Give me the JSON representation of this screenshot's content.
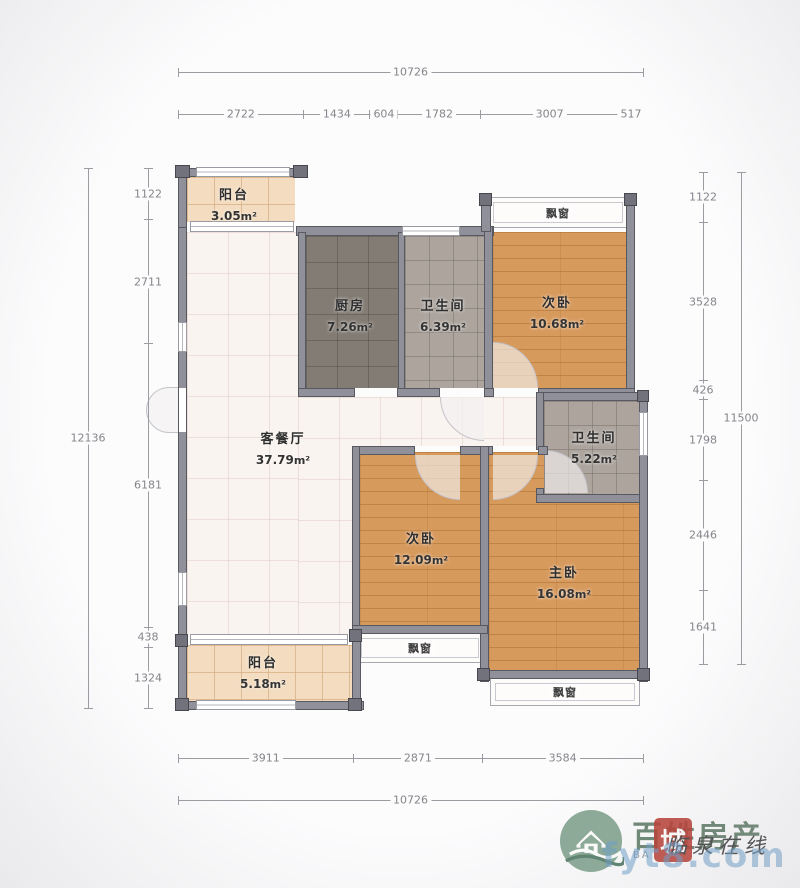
{
  "units": {
    "sqm_unit": "m²"
  },
  "plan": {
    "rooms": {
      "balcony_top": {
        "label": "阳台",
        "area": "3.05"
      },
      "kitchen": {
        "label": "厨房",
        "area": "7.26"
      },
      "bath_top": {
        "label": "卫生间",
        "area": "6.39"
      },
      "bedroom_top": {
        "label": "次卧",
        "area": "10.68"
      },
      "living": {
        "label": "客餐厅",
        "area": "37.79"
      },
      "bath_mid": {
        "label": "卫生间",
        "area": "5.22"
      },
      "bedroom_mid": {
        "label": "次卧",
        "area": "12.09"
      },
      "master": {
        "label": "主卧",
        "area": "16.08"
      },
      "balcony_bottom": {
        "label": "阳台",
        "area": "5.18"
      }
    },
    "bay_window_label": "飘窗"
  },
  "dimensions": {
    "top_total_values": [
      "10726"
    ],
    "top_segments": [
      "2722",
      "1434",
      "604",
      "1782",
      "3007",
      "517"
    ],
    "left_total_values": [
      "12136"
    ],
    "left_segments": [
      "1122",
      "2711",
      "6181",
      "438",
      "1324"
    ],
    "right_segments": [
      "1122",
      "3528",
      "426",
      "1798",
      "2446",
      "1641"
    ],
    "right_total_values": [
      "11500"
    ],
    "bottom_segments": [
      "3911",
      "2871",
      "3584"
    ],
    "bottom_total_values": [
      "10726"
    ]
  },
  "watermark": {
    "brand": "百姓房产",
    "seal_char": "城",
    "script_text": "临泉在线",
    "sub_text": "BA",
    "url": "fyt8.com"
  },
  "colors": {
    "wall": "#90909a",
    "wood_floor": "#d79a5d",
    "kitchen_floor": "#837c74",
    "bath_floor": "#aca49d",
    "balcony_floor": "#f3dcbf",
    "living_floor": "#faf4f0",
    "dim_text": "#85858b",
    "brand_green": "#5e7b66",
    "seal_red": "#ba3e34",
    "url_blue": "#6c9ecb"
  }
}
